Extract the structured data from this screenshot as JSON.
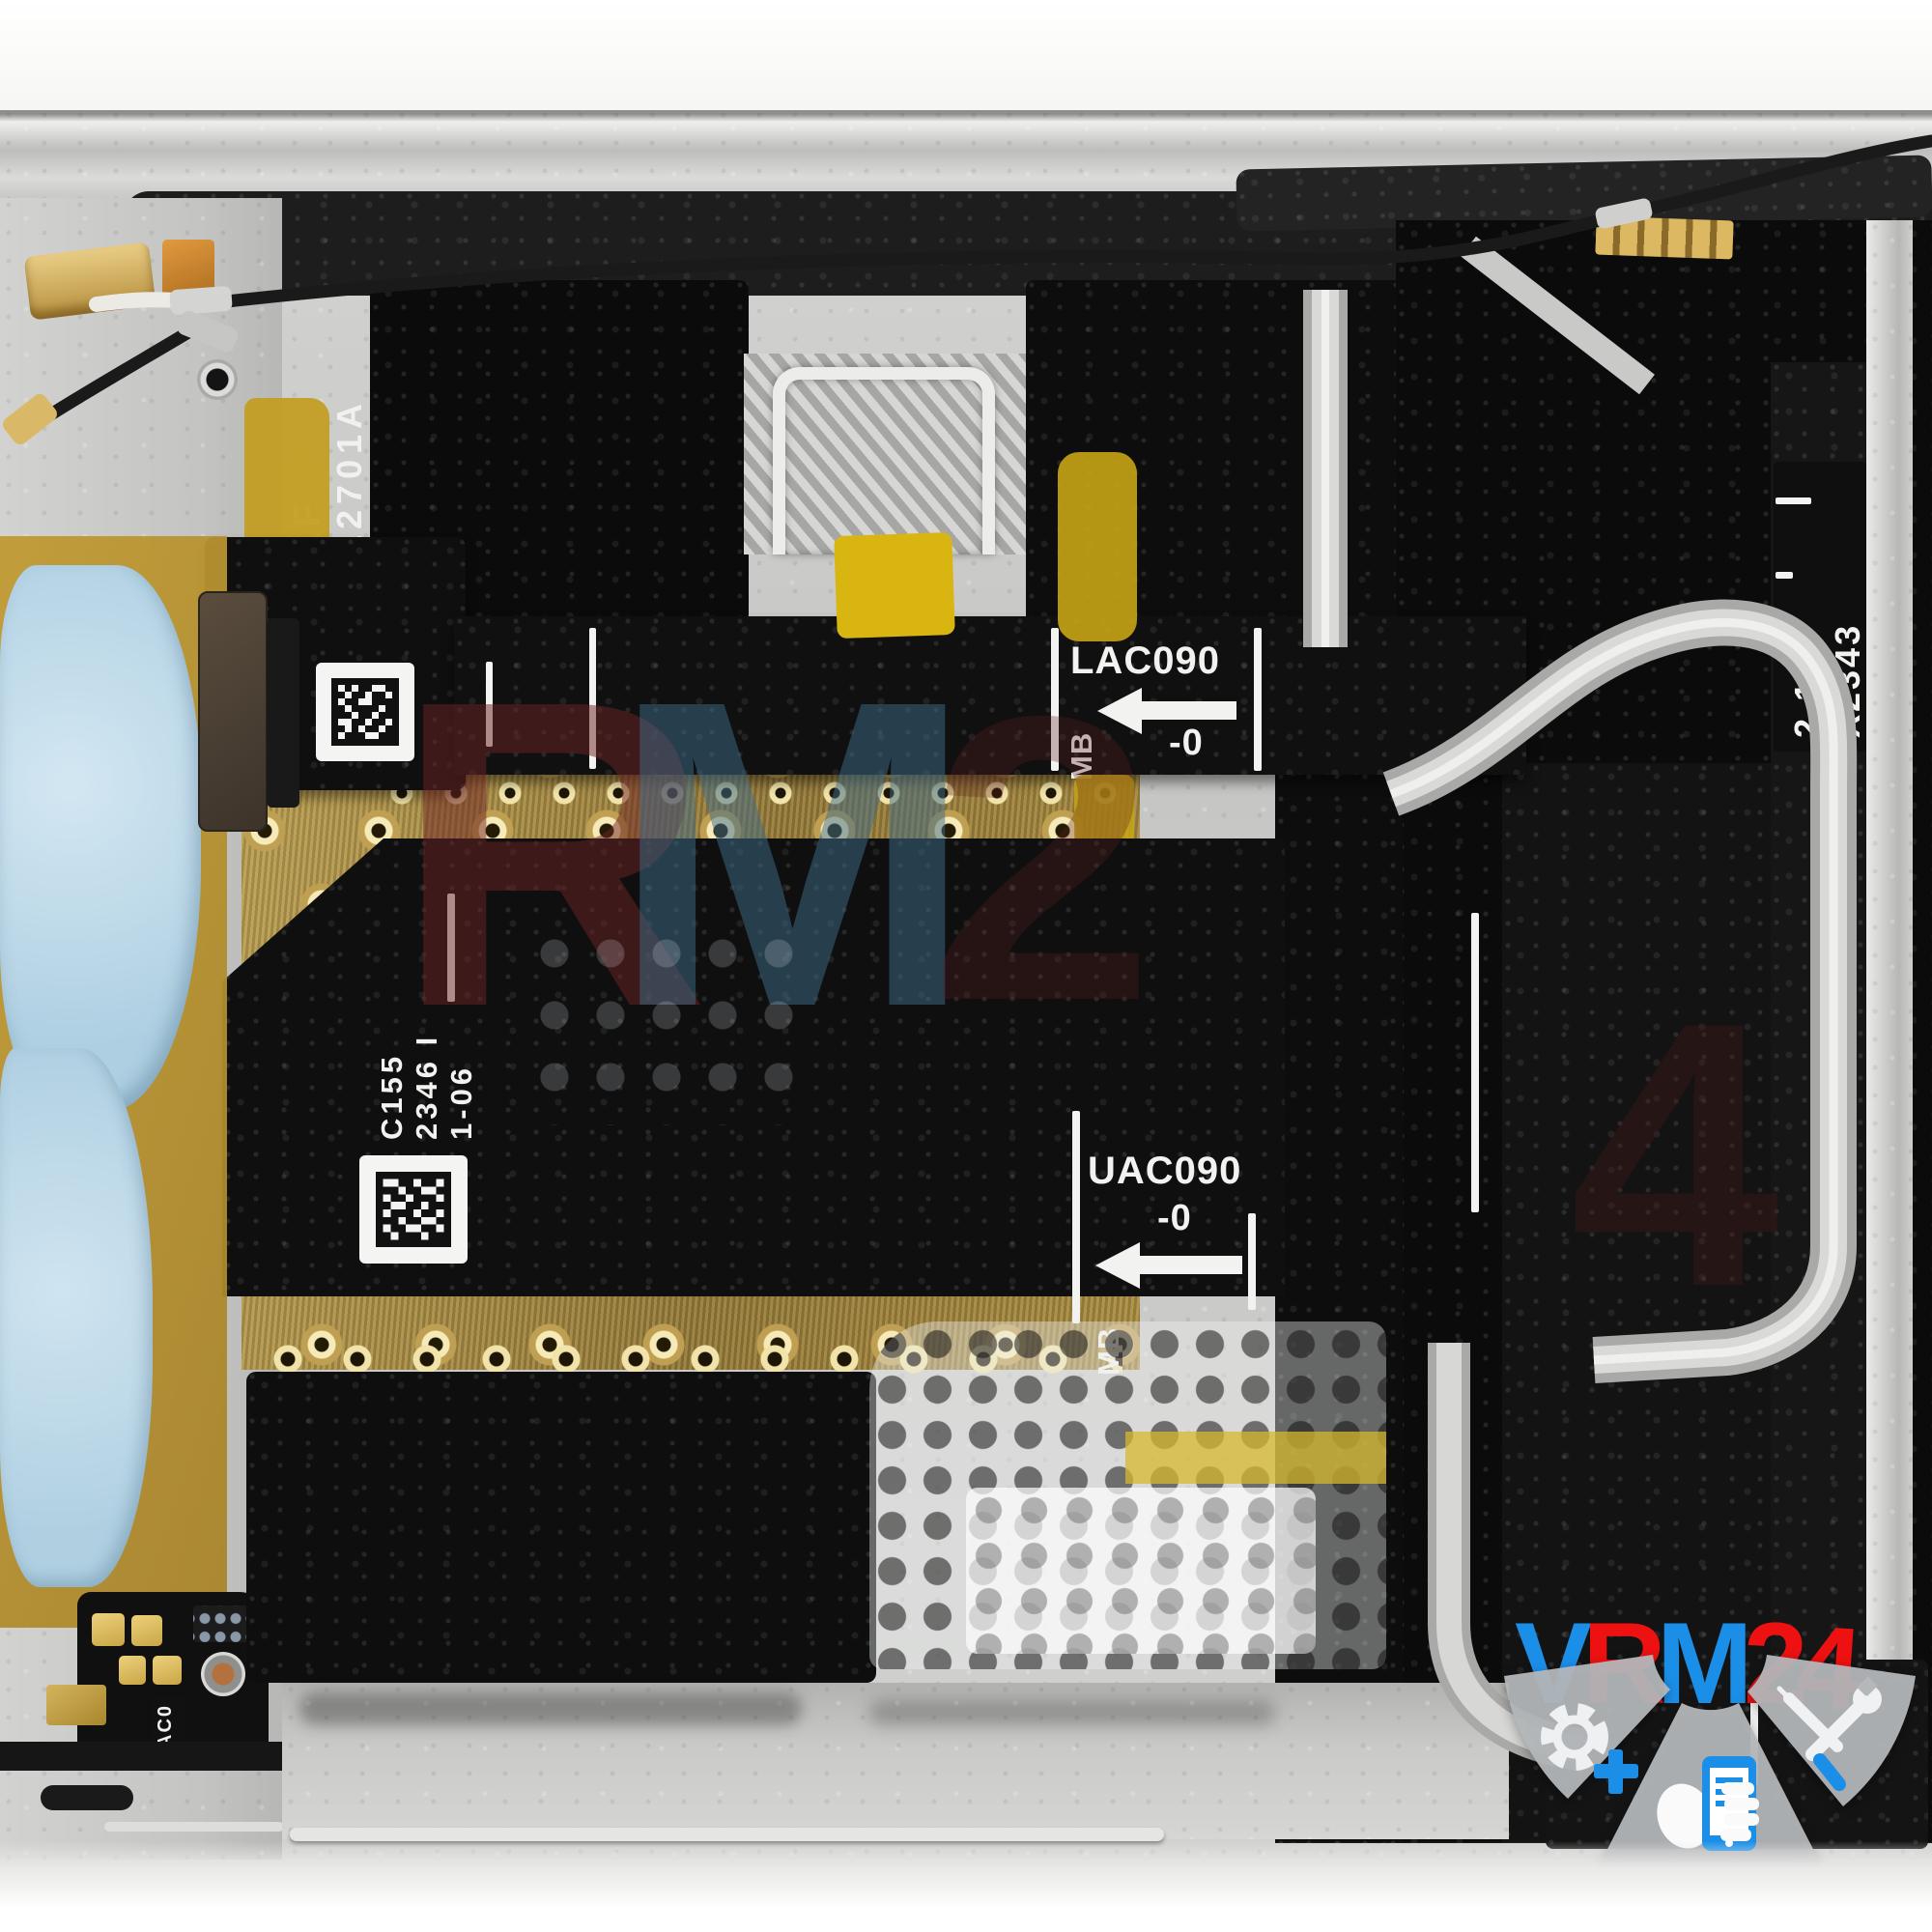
{
  "markings": {
    "frame_etch_line1": "LF",
    "frame_etch_line2": "12701A",
    "upper_flex": {
      "label": "LAC090",
      "origin": "MB",
      "rev": "-0"
    },
    "lower_flex": {
      "label": "UAC090",
      "origin": "MB",
      "rev": "-0"
    },
    "serial_line1": "C155",
    "serial_line2": "2346 I",
    "serial_line3": "1-06",
    "right_flex_line1": "2-14",
    "right_flex_line2": "X2343",
    "bottom_tab": "AC0"
  },
  "watermark": {
    "brand": "VRM24",
    "logo_letters": [
      {
        "char": "V",
        "color": "#1b8fe8"
      },
      {
        "char": "R",
        "color": "#ee1111"
      },
      {
        "char": "M",
        "color": "#1b8fe8"
      },
      {
        "char": "2",
        "color": "#ee1111"
      },
      {
        "char": "4",
        "color": "#ee1111"
      }
    ],
    "center_letters": [
      {
        "char": "R",
        "color": "#6e2424"
      },
      {
        "char": "M",
        "color": "#3f6d8a"
      },
      {
        "char": "2",
        "color": "#5d1f1f"
      },
      {
        "char": "4",
        "color": "#4a1a1a"
      }
    ],
    "logo_icons": [
      "gear-plus-icon",
      "phone-hand-icon",
      "repair-tools-icon"
    ]
  },
  "colors": {
    "frame_silver": "#c2c2c0",
    "foam_dark": "#1f1f1f",
    "flex_black": "#111111",
    "kapton_yellow": "#c8a21c",
    "gold_plate": "#ad924c",
    "thermal_putty_blue": "#b4d3e6",
    "graphite_black": "#0a0a0a",
    "logo_blue": "#1b8fe8",
    "logo_red": "#ee1111"
  }
}
